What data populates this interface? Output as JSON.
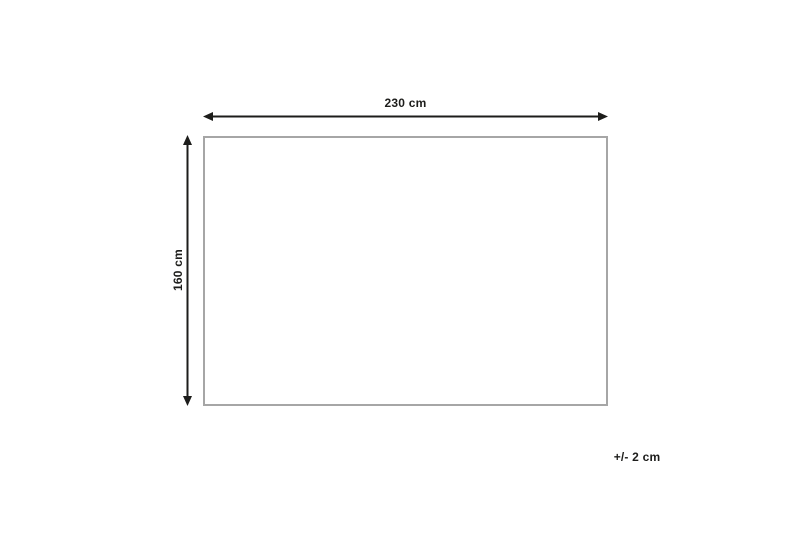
{
  "diagram": {
    "type": "dimension-diagram",
    "shape": "rectangle",
    "width_label": "230 cm",
    "height_label": "160 cm",
    "tolerance_label": "+/- 2 cm",
    "width_cm": 230,
    "height_cm": 160,
    "tolerance_cm": 2
  },
  "colors": {
    "background": "#ffffff",
    "arrow": "#1d1d1b",
    "text": "#1d1d1b",
    "rect_border": "#a6a6a6",
    "rect_fill": "#ffffff"
  }
}
